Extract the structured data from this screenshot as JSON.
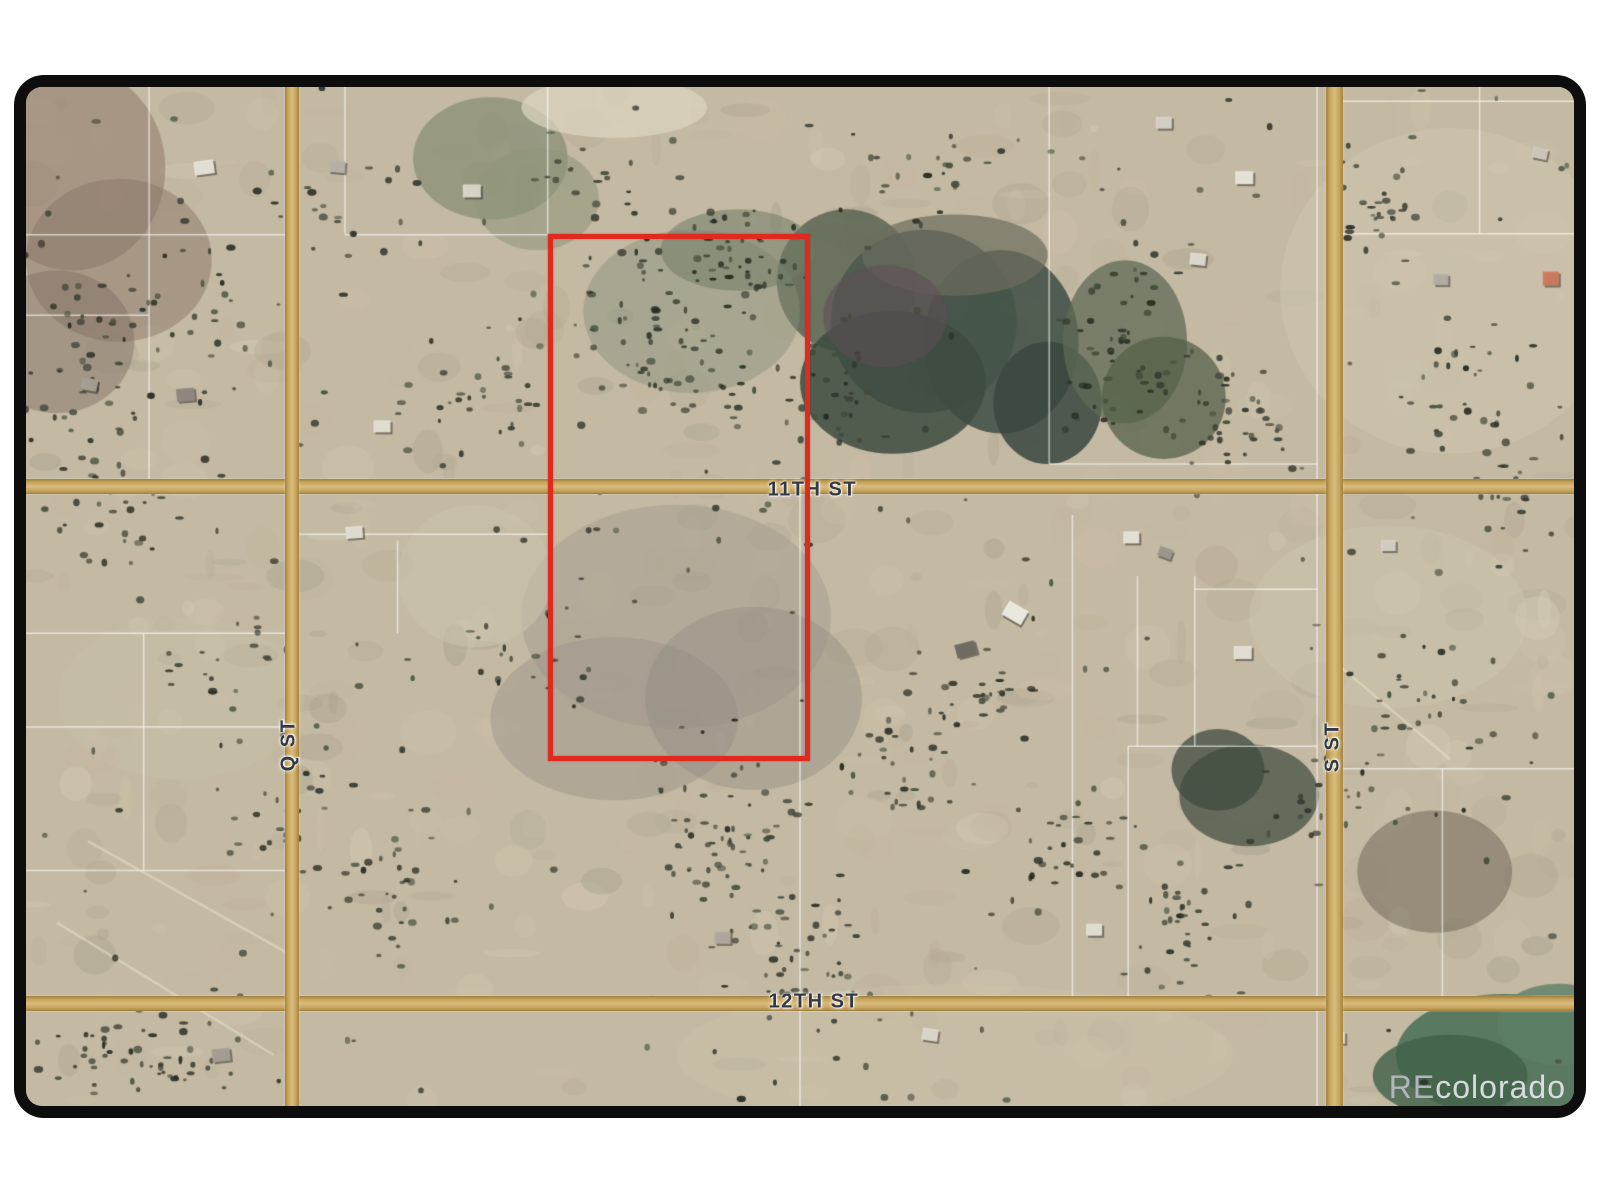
{
  "page": {
    "background": "#ffffff",
    "frame_color": "#0d0d0d"
  },
  "watermark": {
    "prefix": "RE",
    "suffix": "colorado"
  },
  "map": {
    "background": "#c4b9a2",
    "parcel_line_color": "#ffffff",
    "track_color": "#ece4d0",
    "road_color": "#c7a45c",
    "street_label_color": "#333a46",
    "streets": [
      {
        "id": "11th-st",
        "name": "11TH ST",
        "axis": "h",
        "pos_pct": 39.2,
        "thickness_px": 15,
        "label_x_pct": 50.8,
        "label_y_pct": 39.5
      },
      {
        "id": "12th-st",
        "name": "12TH ST",
        "axis": "h",
        "pos_pct": 89.9,
        "thickness_px": 15,
        "label_x_pct": 50.9,
        "label_y_pct": 89.8
      },
      {
        "id": "q-st",
        "name": "Q ST",
        "axis": "v",
        "pos_pct": 17.2,
        "thickness_px": 14,
        "label_x_pct": 17.0,
        "label_y_pct": 64.6
      },
      {
        "id": "s-st",
        "name": "S ST",
        "axis": "v",
        "pos_pct": 84.55,
        "thickness_px": 17,
        "label_x_pct": 84.4,
        "label_y_pct": 64.8
      }
    ],
    "subject_parcel": {
      "left_pct": 33.74,
      "top_pct": 14.43,
      "width_pct": 16.29,
      "height_pct": 50.74,
      "outline_color": "#e02a1f",
      "outline_px": 5
    },
    "parcel_lines": [
      [
        7.95,
        0,
        7.95,
        39.2
      ],
      [
        20.6,
        0,
        20.6,
        14.4
      ],
      [
        33.7,
        0,
        33.7,
        14.4
      ],
      [
        50.0,
        39.2,
        50.0,
        100
      ],
      [
        66.1,
        0,
        66.1,
        37.0
      ],
      [
        67.6,
        42,
        67.6,
        89.9
      ],
      [
        71.2,
        64.7,
        71.2,
        89.9
      ],
      [
        71.8,
        48,
        71.8,
        64.7
      ],
      [
        75.5,
        48,
        75.5,
        64.7
      ],
      [
        83.4,
        0,
        83.4,
        100
      ],
      [
        93.9,
        0,
        93.9,
        14.4
      ],
      [
        7.6,
        53.6,
        7.6,
        76.9
      ],
      [
        24.0,
        44.5,
        24.0,
        53.6
      ],
      [
        91.5,
        66.9,
        91.5,
        89.9
      ],
      [
        0,
        14.5,
        17.2,
        14.5
      ],
      [
        20.6,
        14.5,
        33.7,
        14.5
      ],
      [
        84.6,
        14.4,
        100,
        14.4
      ],
      [
        0,
        22.4,
        7.95,
        22.4
      ],
      [
        66.1,
        37.0,
        83.4,
        37.0
      ],
      [
        0,
        53.6,
        17.2,
        53.6
      ],
      [
        0,
        62.8,
        17.2,
        62.8
      ],
      [
        0,
        76.9,
        17.2,
        76.9
      ],
      [
        75.5,
        49.3,
        83.4,
        49.3
      ],
      [
        84.6,
        66.9,
        100,
        66.9
      ],
      [
        71.2,
        64.7,
        83.4,
        64.7
      ],
      [
        84.6,
        1.4,
        100,
        1.4
      ],
      [
        17.2,
        43.9,
        33.7,
        43.9
      ]
    ],
    "tracks": [
      [
        2,
        82,
        16,
        95
      ],
      [
        4,
        74,
        16.9,
        85
      ],
      [
        85,
        57,
        92,
        66
      ]
    ],
    "terrain_patches": [
      {
        "cx": 53,
        "cy": 19,
        "rx": 4.5,
        "ry": 7,
        "color": "#5c6554",
        "a": 0.85
      },
      {
        "cx": 58,
        "cy": 23,
        "rx": 6,
        "ry": 9,
        "color": "#4c5a4e",
        "a": 0.9
      },
      {
        "cx": 63,
        "cy": 25,
        "rx": 5,
        "ry": 9,
        "color": "#455349",
        "a": 0.9
      },
      {
        "cx": 56,
        "cy": 29,
        "rx": 6,
        "ry": 7,
        "color": "#3d4b41",
        "a": 0.85
      },
      {
        "cx": 60,
        "cy": 16.5,
        "rx": 6,
        "ry": 4,
        "color": "#6c6c5e",
        "a": 0.7
      },
      {
        "cx": 55.5,
        "cy": 22.5,
        "rx": 4,
        "ry": 5,
        "color": "#5e4f55",
        "a": 0.55
      },
      {
        "cx": 66,
        "cy": 31,
        "rx": 3.5,
        "ry": 6,
        "color": "#394740",
        "a": 0.85
      },
      {
        "cx": 71,
        "cy": 25,
        "rx": 4,
        "ry": 8,
        "color": "#5f6b55",
        "a": 0.75
      },
      {
        "cx": 73.5,
        "cy": 30.5,
        "rx": 4,
        "ry": 6,
        "color": "#566149",
        "a": 0.75
      },
      {
        "cx": 30,
        "cy": 7,
        "rx": 5,
        "ry": 6,
        "color": "#7f8870",
        "a": 0.65
      },
      {
        "cx": 33,
        "cy": 11,
        "rx": 4,
        "ry": 5,
        "color": "#8e957a",
        "a": 0.55
      },
      {
        "cx": 43,
        "cy": 22,
        "rx": 7,
        "ry": 8,
        "color": "#87917b",
        "a": 0.45
      },
      {
        "cx": 46,
        "cy": 16,
        "rx": 5,
        "ry": 4,
        "color": "#707c64",
        "a": 0.55
      },
      {
        "cx": 42,
        "cy": 52,
        "rx": 10,
        "ry": 11,
        "color": "#a49c8f",
        "a": 0.5
      },
      {
        "cx": 38,
        "cy": 62,
        "rx": 8,
        "ry": 8,
        "color": "#9a938a",
        "a": 0.45
      },
      {
        "cx": 47,
        "cy": 60,
        "rx": 7,
        "ry": 9,
        "color": "#8f8980",
        "a": 0.4
      },
      {
        "cx": 79,
        "cy": 69.5,
        "rx": 4.5,
        "ry": 5,
        "color": "#4e584a",
        "a": 0.8
      },
      {
        "cx": 77,
        "cy": 67,
        "rx": 3,
        "ry": 4,
        "color": "#3f4b3f",
        "a": 0.75
      },
      {
        "cx": 95.5,
        "cy": 95,
        "rx": 7,
        "ry": 6,
        "color": "#4e7259",
        "a": 0.9
      },
      {
        "cx": 92,
        "cy": 97,
        "rx": 5,
        "ry": 4,
        "color": "#406049",
        "a": 0.8
      },
      {
        "cx": 99,
        "cy": 92,
        "rx": 4,
        "ry": 4,
        "color": "#5d7f66",
        "a": 0.8
      },
      {
        "cx": 3,
        "cy": 8,
        "rx": 6,
        "ry": 10,
        "color": "#8f7a6b",
        "a": 0.55
      },
      {
        "cx": 6,
        "cy": 17,
        "rx": 6,
        "ry": 8,
        "color": "#857264",
        "a": 0.45
      },
      {
        "cx": 2,
        "cy": 25,
        "rx": 5,
        "ry": 7,
        "color": "#7d6d61",
        "a": 0.45
      },
      {
        "cx": 91,
        "cy": 77,
        "rx": 5,
        "ry": 6,
        "color": "#6c6253",
        "a": 0.5
      },
      {
        "cx": 92,
        "cy": 20,
        "rx": 11,
        "ry": 16,
        "color": "#d0c7b1",
        "a": 0.5
      },
      {
        "cx": 60,
        "cy": 95,
        "rx": 18,
        "ry": 7,
        "color": "#ccc2ab",
        "a": 0.4
      },
      {
        "cx": 29,
        "cy": 48,
        "rx": 5,
        "ry": 7,
        "color": "#cac1ac",
        "a": 0.6
      },
      {
        "cx": 38,
        "cy": 2,
        "rx": 6,
        "ry": 3,
        "color": "#ddd5c2",
        "a": 0.7
      },
      {
        "cx": 88,
        "cy": 52,
        "rx": 9,
        "ry": 9,
        "color": "#d0c7b1",
        "a": 0.4
      },
      {
        "cx": 10,
        "cy": 60,
        "rx": 8,
        "ry": 8,
        "color": "#c9c0ab",
        "a": 0.4
      }
    ],
    "tree_clusters": [
      [
        4,
        30,
        5,
        14,
        50
      ],
      [
        12,
        22,
        6,
        10,
        30
      ],
      [
        20,
        12,
        6,
        6,
        18
      ],
      [
        29,
        31,
        6,
        8,
        28
      ],
      [
        40,
        22,
        5,
        10,
        40
      ],
      [
        44,
        29,
        5,
        6,
        30
      ],
      [
        46,
        17,
        5,
        7,
        45
      ],
      [
        52,
        30,
        4,
        8,
        30
      ],
      [
        71,
        26,
        5,
        9,
        50
      ],
      [
        78,
        32,
        5,
        7,
        35
      ],
      [
        87,
        12,
        4,
        7,
        28
      ],
      [
        93,
        30,
        5,
        8,
        28
      ],
      [
        45,
        75,
        6,
        10,
        55
      ],
      [
        49,
        86,
        5,
        8,
        40
      ],
      [
        56,
        66,
        6,
        6,
        30
      ],
      [
        61,
        60,
        5,
        5,
        22
      ],
      [
        24,
        80,
        7,
        9,
        32
      ],
      [
        8,
        95,
        8,
        5,
        50
      ],
      [
        17,
        70,
        6,
        8,
        25
      ],
      [
        68,
        75,
        5,
        7,
        28
      ],
      [
        75,
        81,
        5,
        8,
        32
      ],
      [
        90,
        60,
        6,
        8,
        25
      ],
      [
        96,
        40,
        3,
        8,
        20
      ],
      [
        33,
        55,
        5,
        5,
        18
      ],
      [
        6,
        42,
        4,
        6,
        22
      ],
      [
        59,
        8,
        6,
        5,
        20
      ],
      [
        36,
        8,
        5,
        5,
        16
      ],
      [
        85,
        70,
        4,
        5,
        18
      ],
      [
        13,
        57,
        5,
        5,
        16
      ]
    ],
    "structures": [
      {
        "x": 11.5,
        "y": 7.9,
        "w": 20,
        "h": 14,
        "c": "#e8e4da",
        "rot": -8
      },
      {
        "x": 20.1,
        "y": 7.8,
        "w": 16,
        "h": 12,
        "c": "#b9b2a6",
        "rot": 5
      },
      {
        "x": 28.8,
        "y": 10.2,
        "w": 18,
        "h": 13,
        "c": "#ddd8cc",
        "rot": 0
      },
      {
        "x": 4.1,
        "y": 29.2,
        "w": 16,
        "h": 12,
        "c": "#a7a096",
        "rot": 10
      },
      {
        "x": 10.3,
        "y": 30.2,
        "w": 18,
        "h": 13,
        "c": "#8f8880",
        "rot": -5
      },
      {
        "x": 23.0,
        "y": 33.3,
        "w": 17,
        "h": 12,
        "c": "#e5e1d6",
        "rot": 0
      },
      {
        "x": 78.7,
        "y": 8.9,
        "w": 18,
        "h": 13,
        "c": "#eae6dc",
        "rot": 0
      },
      {
        "x": 75.7,
        "y": 16.9,
        "w": 16,
        "h": 12,
        "c": "#e0dcd2",
        "rot": 6
      },
      {
        "x": 91.4,
        "y": 18.9,
        "w": 15,
        "h": 11,
        "c": "#b5aea2",
        "rot": 0
      },
      {
        "x": 98.5,
        "y": 18.8,
        "w": 16,
        "h": 14,
        "c": "#cc7a5e",
        "rot": 0
      },
      {
        "x": 21.2,
        "y": 43.7,
        "w": 17,
        "h": 12,
        "c": "#e3dfd4",
        "rot": -4
      },
      {
        "x": 63.9,
        "y": 51.6,
        "w": 22,
        "h": 16,
        "c": "#efece4",
        "rot": 30
      },
      {
        "x": 60.7,
        "y": 55.2,
        "w": 20,
        "h": 14,
        "c": "#6e6a62",
        "rot": -15
      },
      {
        "x": 71.4,
        "y": 44.2,
        "w": 16,
        "h": 12,
        "c": "#e8e4da",
        "rot": 0
      },
      {
        "x": 73.6,
        "y": 45.7,
        "w": 14,
        "h": 10,
        "c": "#9d978c",
        "rot": 20
      },
      {
        "x": 78.6,
        "y": 55.5,
        "w": 18,
        "h": 13,
        "c": "#e6e2d8",
        "rot": 0
      },
      {
        "x": 45.0,
        "y": 83.5,
        "w": 16,
        "h": 12,
        "c": "#b0a99d",
        "rot": 0
      },
      {
        "x": 58.4,
        "y": 93.0,
        "w": 16,
        "h": 12,
        "c": "#ded9ce",
        "rot": 8
      },
      {
        "x": 69.0,
        "y": 82.7,
        "w": 16,
        "h": 12,
        "c": "#e4e0d6",
        "rot": 0
      },
      {
        "x": 84.7,
        "y": 93.3,
        "w": 16,
        "h": 12,
        "c": "#dcd7cc",
        "rot": 0
      },
      {
        "x": 12.6,
        "y": 95.0,
        "w": 18,
        "h": 13,
        "c": "#a59e93",
        "rot": -6
      },
      {
        "x": 73.5,
        "y": 3.5,
        "w": 16,
        "h": 12,
        "c": "#d8d3c8",
        "rot": 0
      },
      {
        "x": 97.8,
        "y": 6.5,
        "w": 15,
        "h": 11,
        "c": "#cfc9bd",
        "rot": 12
      },
      {
        "x": 88.0,
        "y": 45.0,
        "w": 15,
        "h": 11,
        "c": "#d5d0c5",
        "rot": 0
      }
    ],
    "texture": {
      "seed": 7,
      "mottle_count": 520,
      "mottle_palette": [
        "#cfc5ae",
        "#baaf98",
        "#d9d0bb",
        "#a8a18e",
        "#c3b7a1",
        "#9f9c8b",
        "#cec3ac",
        "#b1a791"
      ],
      "scatter_trees": 250,
      "tree_palette": [
        "#2c3127",
        "#3a3f33",
        "#242920",
        "#434c3a"
      ]
    }
  }
}
